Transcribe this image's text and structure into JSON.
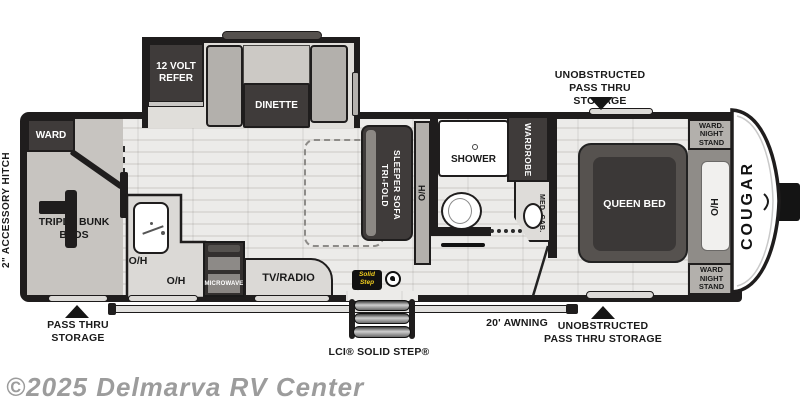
{
  "page": {
    "watermark": "©2025 Delmarva RV Center"
  },
  "brand": {
    "name": "COUGAR"
  },
  "callouts": {
    "top_storage_line1": "UNOBSTRUCTED",
    "top_storage_line2": "PASS THRU STORAGE",
    "rear_storage_line1": "PASS THRU",
    "rear_storage_line2": "STORAGE",
    "front_storage_line1": "UNOBSTRUCTED",
    "front_storage_line2": "PASS THRU STORAGE",
    "awning": "20'  AWNING",
    "step": "LCI® SOLID STEP®",
    "hitch": "2\" ACCESSORY HITCH"
  },
  "rooms": {
    "ward": "WARD",
    "refer": "12 VOLT REFER",
    "dinette": "DINETTE",
    "bunks": "TRIPLE BUNK BEDS",
    "sofa_line1": "TRI-FOLD",
    "sofa_line2": "SLEEPER SOFA",
    "overhead": "O/H",
    "shower": "SHOWER",
    "wardrobe": "WARDROBE",
    "med_cab": "MED. CAB.",
    "queen_bed": "QUEEN BED",
    "nightstand_front_top": "WARD. NIGHT STAND",
    "nightstand_front_bottom": "WARD NIGHT STAND",
    "microwave": "MICROWAVE",
    "tv": "TV/RADIO"
  },
  "badge": {
    "line1": "Solid",
    "line2": "Step"
  },
  "colors": {
    "wall": "#1f1d1d",
    "dark_furniture": "#3f3b3a",
    "floor_light": "#e8e7e5",
    "watermark": "#9c9c9c",
    "badge_yellow": "#f0cd1e"
  }
}
